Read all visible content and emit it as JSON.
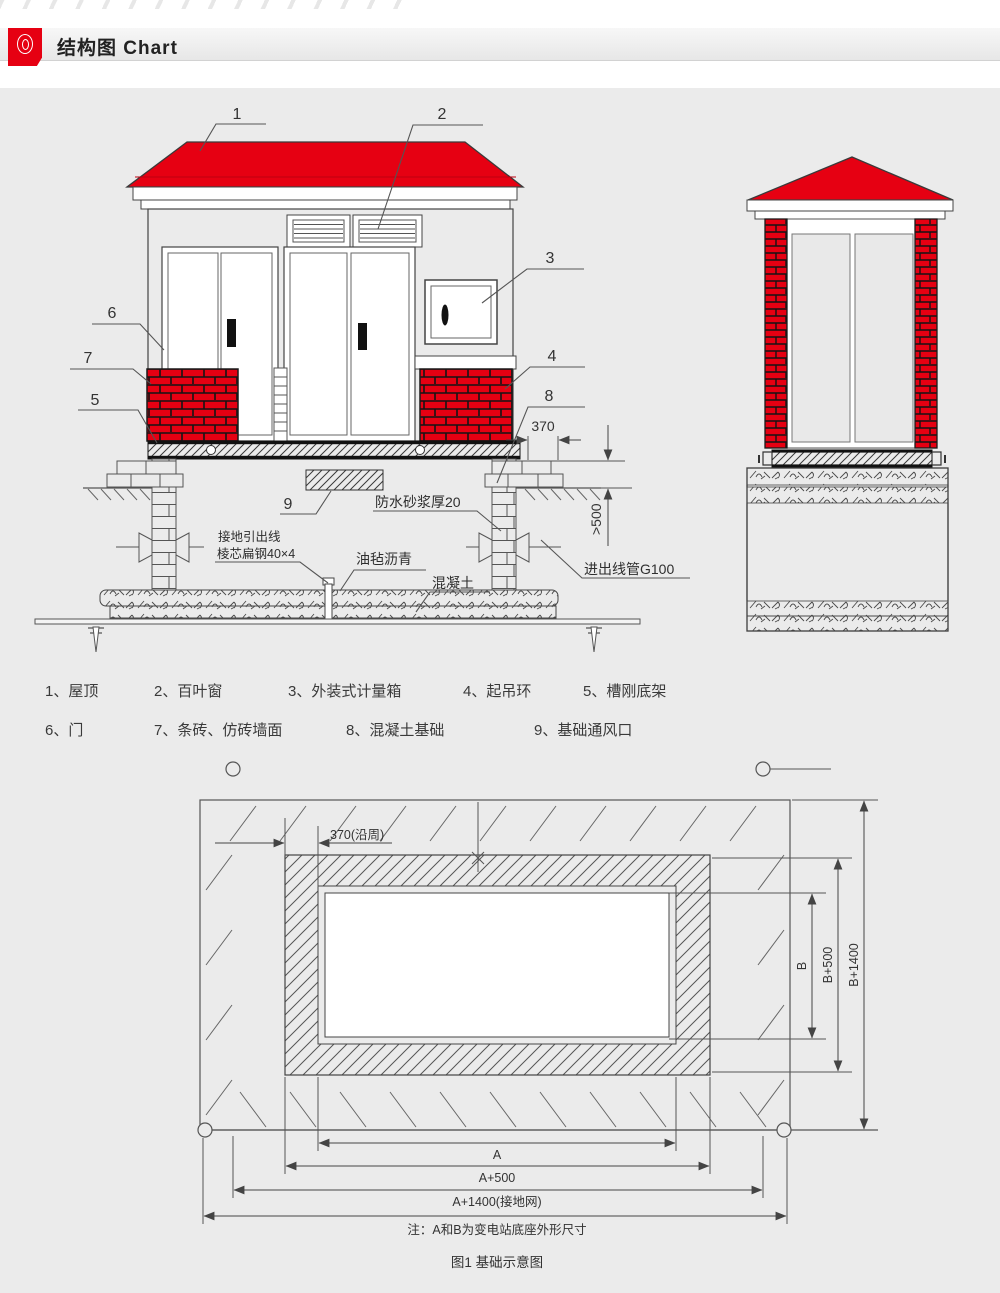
{
  "header": {
    "title": "结构图 Chart",
    "accent_color": "#e60012"
  },
  "front": {
    "callouts": [
      "1",
      "2",
      "3",
      "4",
      "5",
      "6",
      "7",
      "8",
      "9"
    ],
    "labels": {
      "waterproof": "防水砂浆厚20",
      "ground1": "接地引出线",
      "ground2": "棱芯扁钢40×4",
      "asphalt": "油毡沥青",
      "concrete": "混凝土",
      "conduit": "进出线管G100"
    },
    "dims": {
      "offset": "370",
      "depth": ">500"
    }
  },
  "legend": {
    "items": [
      "1、屋顶",
      "2、百叶窗",
      "3、外装式计量箱",
      "4、起吊环",
      "5、槽刚底架",
      "6、门",
      "7、条砖、仿砖墙面",
      "8、混凝土基础",
      "9、基础通风口"
    ]
  },
  "plan": {
    "dims": {
      "ring": "370(沿周)",
      "a": "A",
      "a500": "A+500",
      "a1400": "A+1400(接地网)",
      "b": "B",
      "b500": "B+500",
      "b1400": "B+1400"
    },
    "note": "注：A和B为变电站底座外形尺寸",
    "caption": "图1 基础示意图"
  }
}
